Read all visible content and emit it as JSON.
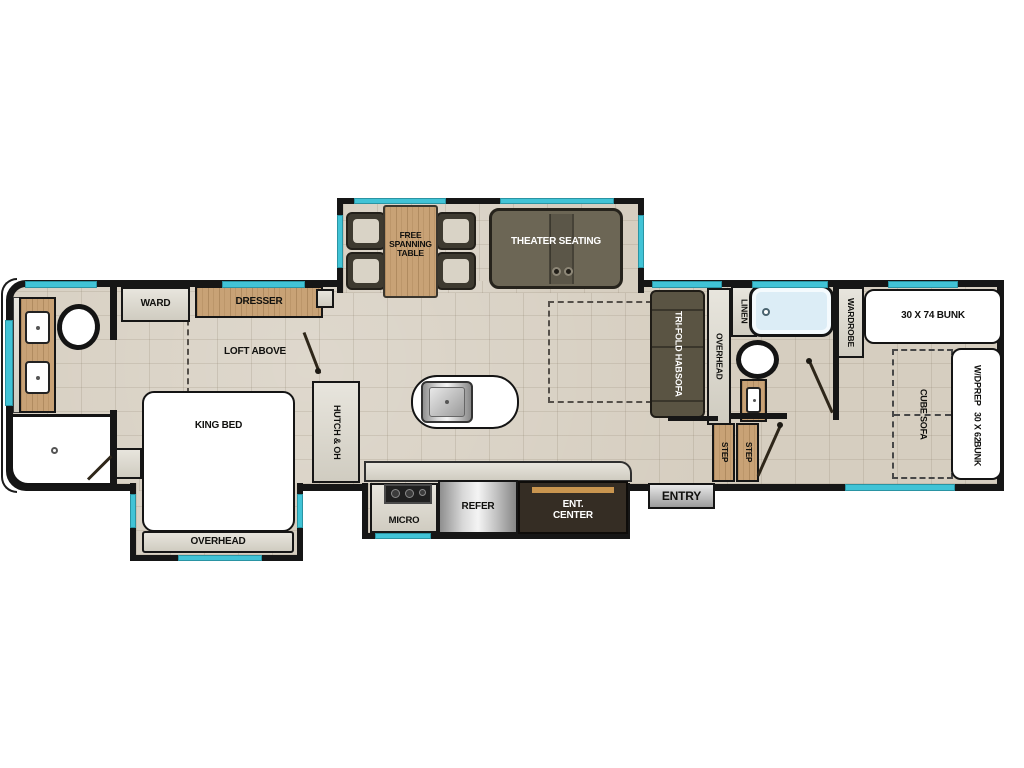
{
  "colors": {
    "wall": "#161616",
    "window_accent": "#41c3d6",
    "floor": "#d6cec0",
    "wood": "#c8a276",
    "cabinet": "#dbd7cb",
    "dark_sofa": "#5a5443",
    "theater_sofa": "#6c6655",
    "ent_center": "#352d24",
    "tub_fill": "#dcedf6"
  },
  "bedroom": {
    "ward": "WARD",
    "dresser": "DRESSER",
    "loft": "LOFT ABOVE",
    "king_bed": "KING BED",
    "overhead": "OVERHEAD"
  },
  "dinette": {
    "table_l1": "FREE",
    "table_l2": "SPANNING",
    "table_l3": "TABLE",
    "theater": "THEATER SEATING"
  },
  "kitchen": {
    "hutch": "HUTCH & OH",
    "micro": "MICRO",
    "refer": "REFER",
    "ent_l1": "ENT.",
    "ent_l2": "CENTER"
  },
  "living": {
    "sofa_l1": "TRI-FOLD HAB",
    "sofa_l2": "SOFA",
    "overhead": "OVERHEAD"
  },
  "rear_bath": {
    "linen": "LINEN"
  },
  "bunk_room": {
    "wardrobe": "WARDROBE",
    "bunk74": "30 X 74 BUNK",
    "wd_l1": "W/D",
    "wd_l2": "PREP",
    "bunk62_l1": "30 X 62",
    "bunk62_l2": "BUNK",
    "cube_sofa": "CUBE SOFA",
    "step": "STEP"
  },
  "entry": {
    "label": "ENTRY"
  }
}
